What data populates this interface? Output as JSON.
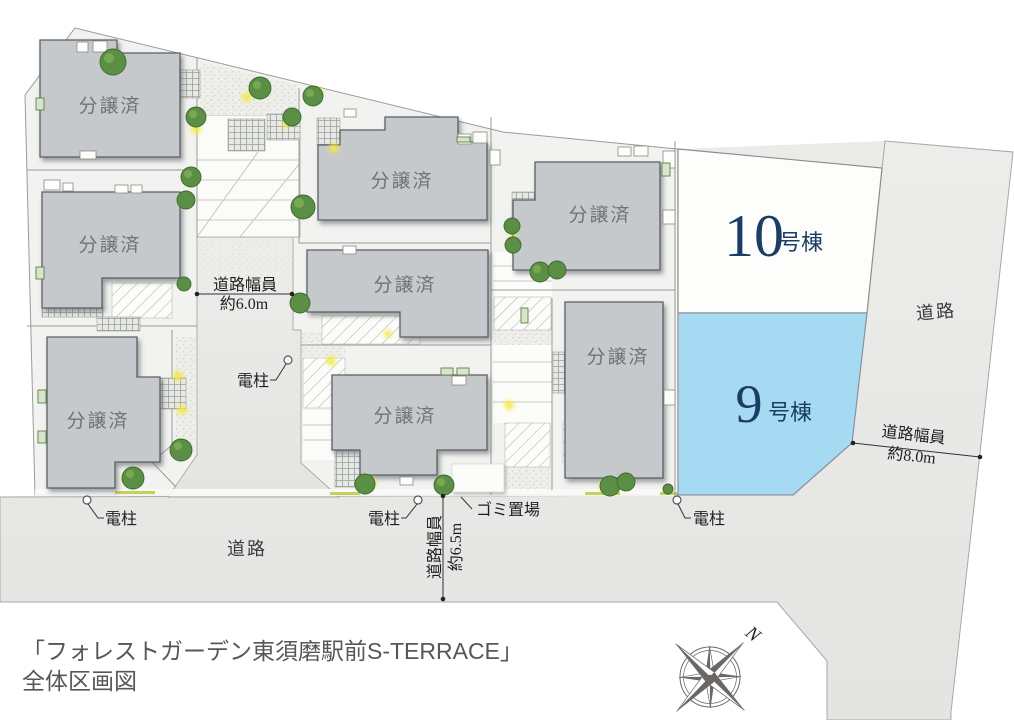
{
  "title": {
    "line1": "「フォレストガーデン東須磨駅前S-TERRACE」",
    "line2": "全体区画図"
  },
  "map": {
    "sold_label": "分譲済",
    "lot10": {
      "number": "10",
      "suffix": "号棟"
    },
    "lot9": {
      "number": "9",
      "suffix": "号棟"
    },
    "road_label": "道路",
    "road_width_label": "道路幅員",
    "road_width_6_0": "約6.0m",
    "road_width_6_5": "約6.5m",
    "road_width_8_0": "約8.0m",
    "utility_pole": "電柱",
    "garbage_area": "ゴミ置場",
    "compass_north": "N"
  },
  "colors": {
    "lot9_fill": "#a6daf3",
    "lot10_fill": "#fdfdfc",
    "building_fill": "#c5c9cc",
    "lot_number_color": "#1b3d66",
    "ground_fill": "#f2f2f0",
    "road_fill": "#e9e9e7"
  }
}
